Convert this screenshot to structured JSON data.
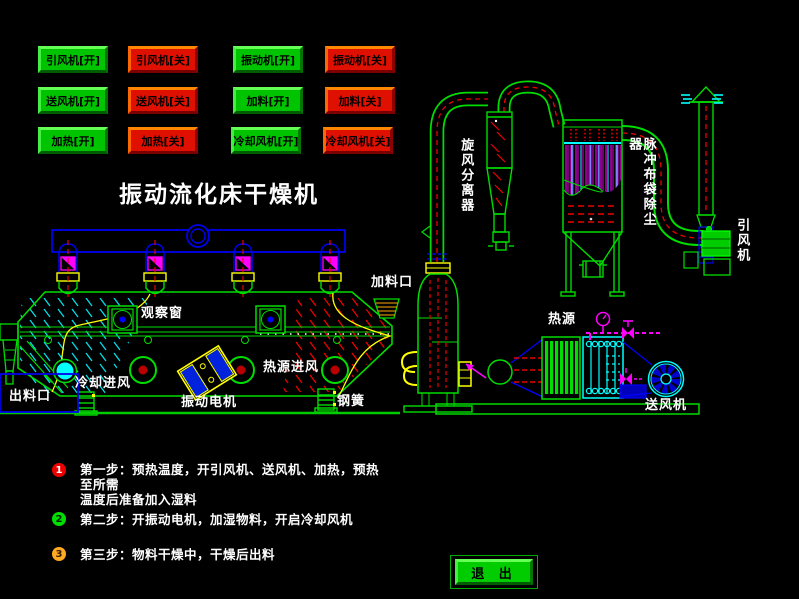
{
  "title": "振动流化床干燥机",
  "buttons": [
    {
      "label": "引风机[开]"
    },
    {
      "label": "引风机[关]"
    },
    {
      "label": "振动机[开]"
    },
    {
      "label": "振动机[关]"
    },
    {
      "label": "送风机[开]"
    },
    {
      "label": "送风机[关]"
    },
    {
      "label": "加料[开]"
    },
    {
      "label": "加料[关]"
    },
    {
      "label": "加热[开]"
    },
    {
      "label": "加热[关]"
    },
    {
      "label": "冷却风机[开]"
    },
    {
      "label": "冷却风机[关]"
    }
  ],
  "diagram_labels": {
    "cyclone": "旋风分离器",
    "bag_filter": "脉冲布袋除尘器",
    "induced_fan": "引风机",
    "feed_port": "加料口",
    "observation_window": "观察窗",
    "heat_inlet": "热源进风",
    "cooling_inlet": "冷却进风",
    "discharge_port": "出料口",
    "vibration_motor": "振动电机",
    "steel_spring": "钢簧",
    "heat_source": "热源",
    "supply_fan": "送风机"
  },
  "steps": [
    {
      "num": "1",
      "text": "第一步：预热温度，开引风机、送风机、加热，预热至所需\n温度后准备加入湿料"
    },
    {
      "num": "2",
      "text": "第二步：开振动电机，加湿物料，开启冷却风机"
    },
    {
      "num": "3",
      "text": "第三步：物料干燥中，干燥后出料"
    }
  ],
  "exit_label": "退 出",
  "colors": {
    "on_button": "#00c400",
    "off_button": "#e01000",
    "line_green": "#00dd00",
    "line_blue": "#0000ee",
    "line_cyan": "#00ffff",
    "line_magenta": "#ff00ff",
    "line_red": "#ee0000",
    "line_yellow": "#ffff00",
    "step1_badge": "#ee0000",
    "step2_badge": "#00dd00",
    "step3_badge": "#ffaa22"
  }
}
